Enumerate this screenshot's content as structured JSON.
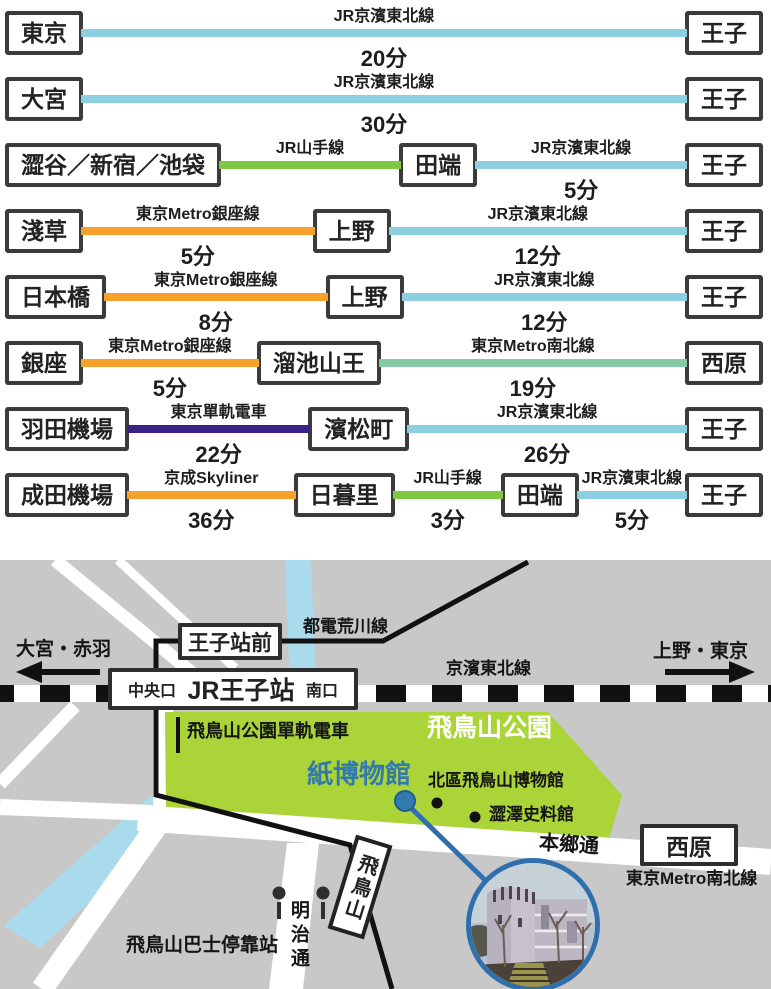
{
  "routes": [
    {
      "items": [
        {
          "type": "station",
          "label": "東京"
        },
        {
          "type": "leg",
          "line": "JR京濱東北線",
          "minutes": "20分",
          "color": "#8ccfe0"
        },
        {
          "type": "station",
          "label": "王子"
        }
      ]
    },
    {
      "items": [
        {
          "type": "station",
          "label": "大宮"
        },
        {
          "type": "leg",
          "line": "JR京濱東北線",
          "minutes": "30分",
          "color": "#8ccfe0"
        },
        {
          "type": "station",
          "label": "王子"
        }
      ]
    },
    {
      "items": [
        {
          "type": "station",
          "label": "澀谷／新宿／池袋"
        },
        {
          "type": "leg",
          "line": "JR山手線",
          "minutes": "",
          "color": "#7dc742"
        },
        {
          "type": "station",
          "label": "田端"
        },
        {
          "type": "leg",
          "line": "JR京濱東北線",
          "minutes": "5分",
          "color": "#8ccfe0"
        },
        {
          "type": "station",
          "label": "王子"
        }
      ]
    },
    {
      "items": [
        {
          "type": "station",
          "label": "淺草"
        },
        {
          "type": "leg",
          "line": "東京Metro銀座線",
          "minutes": "5分",
          "color": "#f6a12b"
        },
        {
          "type": "station",
          "label": "上野"
        },
        {
          "type": "leg",
          "line": "JR京濱東北線",
          "minutes": "12分",
          "color": "#8ccfe0"
        },
        {
          "type": "station",
          "label": "王子"
        }
      ]
    },
    {
      "items": [
        {
          "type": "station",
          "label": "日本橋"
        },
        {
          "type": "leg",
          "line": "東京Metro銀座線",
          "minutes": "8分",
          "color": "#f6a12b"
        },
        {
          "type": "station",
          "label": "上野"
        },
        {
          "type": "leg",
          "line": "JR京濱東北線",
          "minutes": "12分",
          "color": "#8ccfe0"
        },
        {
          "type": "station",
          "label": "王子"
        }
      ]
    },
    {
      "items": [
        {
          "type": "station",
          "label": "銀座"
        },
        {
          "type": "leg",
          "line": "東京Metro銀座線",
          "minutes": "5分",
          "color": "#f6a12b"
        },
        {
          "type": "station",
          "label": "溜池山王"
        },
        {
          "type": "leg",
          "line": "東京Metro南北線",
          "minutes": "19分",
          "color": "#85caa4"
        },
        {
          "type": "station",
          "label": "西原"
        }
      ]
    },
    {
      "items": [
        {
          "type": "station",
          "label": "羽田機場"
        },
        {
          "type": "leg",
          "line": "東京單軌電車",
          "minutes": "22分",
          "color": "#392386"
        },
        {
          "type": "station",
          "label": "濱松町"
        },
        {
          "type": "leg",
          "line": "JR京濱東北線",
          "minutes": "26分",
          "color": "#8ccfe0"
        },
        {
          "type": "station",
          "label": "王子"
        }
      ]
    },
    {
      "items": [
        {
          "type": "station",
          "label": "成田機場"
        },
        {
          "type": "leg",
          "line": "京成Skyliner",
          "minutes": "36分",
          "color": "#f6a12b"
        },
        {
          "type": "station",
          "label": "日暮里"
        },
        {
          "type": "leg",
          "line": "JR山手線",
          "minutes": "3分",
          "color": "#7dc742"
        },
        {
          "type": "station",
          "label": "田端"
        },
        {
          "type": "leg",
          "line": "JR京濱東北線",
          "minutes": "5分",
          "color": "#8ccfe0"
        },
        {
          "type": "station",
          "label": "王子"
        }
      ]
    }
  ],
  "map": {
    "labels": {
      "left_direction": "大宮・赤羽",
      "right_direction": "上野・東京",
      "toden_line": "都電荒川線",
      "keihin_tohoku": "京濱東北線",
      "oji_ekimae": "王子站前",
      "jr_oji": "JR王子站",
      "central_exit": "中央口",
      "south_exit": "南口",
      "park_monorail": "飛鳥山公園單軌電車",
      "park": "飛鳥山公園",
      "paper_museum": "紙博物館",
      "kita_museum": "北區飛鳥山博物館",
      "shibusawa_museum": "澀澤史料館",
      "hongo_dori": "本鄉通",
      "nishigahara": "西原",
      "namboku_line": "東京Metro南北線",
      "asukayama_stop": "飛鳥山",
      "bus_stop": "飛鳥山巴士停靠站",
      "meiji_dori": "明治通"
    },
    "colors": {
      "background": "#c8c8c8",
      "road": "#ffffff",
      "park": "#aad437",
      "river": "#a9dbec",
      "rail_black": "#111111",
      "accent_blue": "#3279ae"
    }
  }
}
